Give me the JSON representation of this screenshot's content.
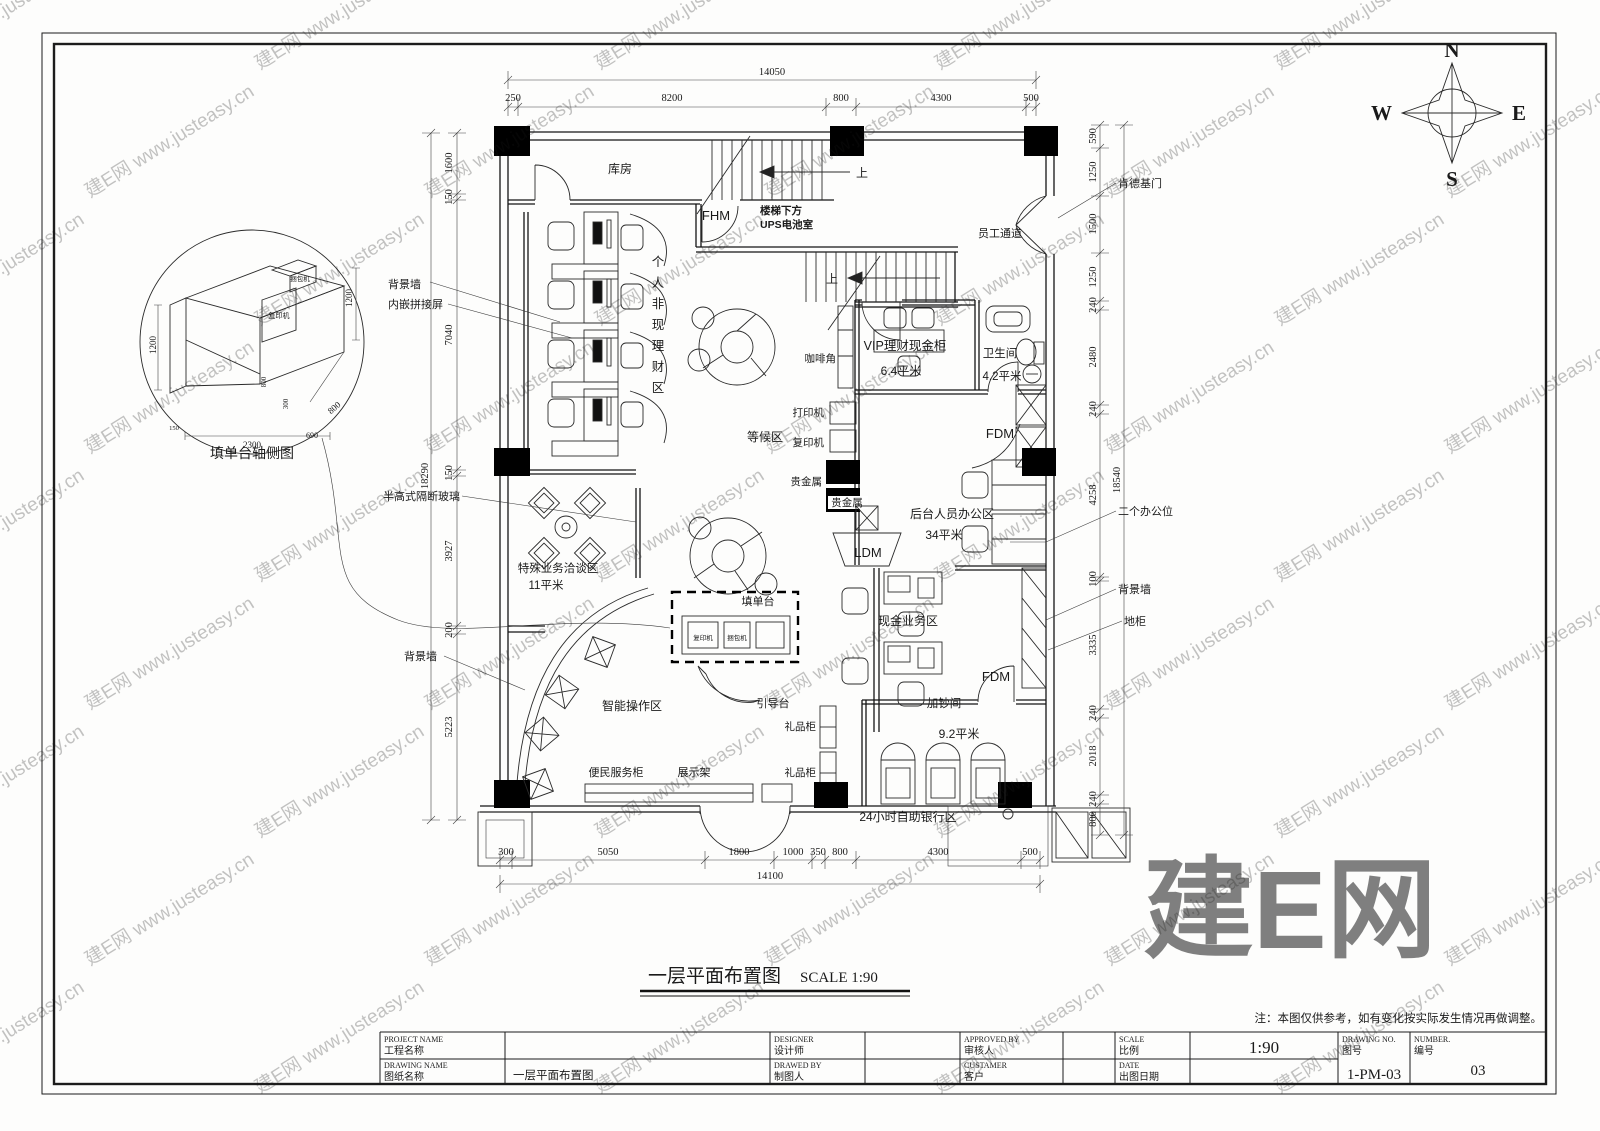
{
  "watermark": {
    "text": "建E网 www.justeasy.cn",
    "big": "建E网"
  },
  "drawing_title": {
    "text": "一层平面布置图",
    "scale": "SCALE 1:90"
  },
  "note": "注：本图仅供参考，如有变化按实际发生情况再做调整。",
  "compass": {
    "n": "N",
    "e": "E",
    "s": "S",
    "w": "W"
  },
  "detail": {
    "caption": "填单台轴侧图",
    "machine_top": "捆包机",
    "machine_front": "复印机",
    "dims": [
      "1200",
      "1200",
      "800",
      "300",
      "800",
      "690",
      "2300",
      "150"
    ]
  },
  "title_block": {
    "fields": [
      {
        "en": "PROJECT NAME",
        "zh": "工程名称",
        "value": ""
      },
      {
        "en": "DRAWING NAME",
        "zh": "图纸名称",
        "value": "一层平面布置图"
      },
      {
        "en": "DESIGNER",
        "zh": "设计师",
        "value": ""
      },
      {
        "en": "DRAWED BY",
        "zh": "制图人",
        "value": ""
      },
      {
        "en": "APPROVED BY",
        "zh": "审核人",
        "value": ""
      },
      {
        "en": "CUSTAMER",
        "zh": "客户",
        "value": ""
      },
      {
        "en": "SCALE",
        "zh": "比例",
        "value": "1:90"
      },
      {
        "en": "DATE",
        "zh": "出图日期",
        "value": ""
      },
      {
        "en": "DRAWING NO.",
        "zh": "图号",
        "value": "1-PM-03"
      },
      {
        "en": "NUMBER.",
        "zh": "编号",
        "value": "03"
      }
    ]
  },
  "dimensions": {
    "top": {
      "overall": "14050",
      "segments": [
        "250",
        "8200",
        "800",
        "4300",
        "500"
      ]
    },
    "bottom": {
      "overall": "14100",
      "segments": [
        "300",
        "5050",
        "1800",
        "1000",
        "350",
        "800",
        "4300",
        "500"
      ]
    },
    "left": {
      "overall": "18290",
      "segments": [
        "1600",
        "150",
        "7040",
        "150",
        "3927",
        "200",
        "5223"
      ]
    },
    "right": {
      "overall": "18540",
      "segments": [
        "590",
        "1250",
        "1500",
        "1250",
        "240",
        "2480",
        "240",
        "4258",
        "100",
        "3335",
        "240",
        "2018",
        "240",
        "800"
      ]
    }
  },
  "plan": {
    "labels": [
      {
        "i": "storeroom",
        "x": 620,
        "y": 173,
        "t": "库房"
      },
      {
        "i": "fhm-door",
        "x": 716,
        "y": 220,
        "t": "FHM",
        "s": 13
      },
      {
        "i": "ups-room-line1",
        "x": 760,
        "y": 214,
        "t": "楼梯下方",
        "s": 10.5,
        "a": "s",
        "b": 1
      },
      {
        "i": "ups-room-line2",
        "x": 760,
        "y": 228,
        "t": "UPS电池室",
        "s": 10.5,
        "a": "s",
        "b": 1
      },
      {
        "i": "stairs-up-1",
        "x": 862,
        "y": 177,
        "t": "上",
        "s": 12
      },
      {
        "i": "stairs-up-2",
        "x": 838,
        "y": 283,
        "t": "上",
        "s": 12,
        "a": "e"
      },
      {
        "i": "personal-finance-zone",
        "x": 658,
        "y": 266,
        "t": "个人非现理财区",
        "s": 12.5,
        "v": 1
      },
      {
        "i": "waiting-zone",
        "x": 765,
        "y": 441,
        "t": "等候区",
        "s": 12
      },
      {
        "i": "staff-corridor",
        "x": 1000,
        "y": 237,
        "t": "员工通道",
        "s": 11
      },
      {
        "i": "coffee-corner",
        "x": 836,
        "y": 362,
        "t": "咖啡角",
        "s": 10.5,
        "a": "e"
      },
      {
        "i": "vip-cash-room",
        "x": 905,
        "y": 350,
        "t": "VIP理财现金柜",
        "s": 12.5
      },
      {
        "i": "vip-cash-area",
        "x": 901,
        "y": 375,
        "t": "6.4平米",
        "s": 12
      },
      {
        "i": "toilet",
        "x": 1000,
        "y": 357,
        "t": "卫生间",
        "s": 11.5
      },
      {
        "i": "toilet-area",
        "x": 1002,
        "y": 380,
        "t": "4.2平米",
        "s": 11.5
      },
      {
        "i": "printer",
        "x": 824,
        "y": 416,
        "t": "打印机",
        "s": 10.5,
        "a": "e"
      },
      {
        "i": "copier",
        "x": 824,
        "y": 446,
        "t": "复印机",
        "s": 10.5,
        "a": "e"
      },
      {
        "i": "precious-metal-1",
        "x": 822,
        "y": 485,
        "t": "贵金属",
        "s": 10.5,
        "a": "e"
      },
      {
        "i": "precious-metal-2",
        "x": 847,
        "y": 506,
        "t": "贵金属",
        "s": 10.5
      },
      {
        "i": "fdm-upper",
        "x": 1000,
        "y": 438,
        "t": "FDM",
        "s": 13
      },
      {
        "i": "backoffice-zone",
        "x": 952,
        "y": 518,
        "t": "后台人员办公区",
        "s": 12
      },
      {
        "i": "backoffice-area",
        "x": 944,
        "y": 539,
        "t": "34平米",
        "s": 12
      },
      {
        "i": "ldm-machine",
        "x": 868,
        "y": 557,
        "t": "LDM",
        "s": 13
      },
      {
        "i": "cash-business-zone",
        "x": 908,
        "y": 625,
        "t": "现金业务区",
        "s": 12
      },
      {
        "i": "form-desk",
        "x": 758,
        "y": 605,
        "t": "填单台",
        "s": 11
      },
      {
        "i": "special-business-zone",
        "x": 558,
        "y": 572,
        "t": "特殊业务洽谈区",
        "s": 11.5
      },
      {
        "i": "special-business-area",
        "x": 546,
        "y": 589,
        "t": "11平米",
        "s": 11.5
      },
      {
        "i": "smart-zone",
        "x": 632,
        "y": 710,
        "t": "智能操作区",
        "s": 12
      },
      {
        "i": "guide-desk",
        "x": 773,
        "y": 707,
        "t": "引导台",
        "s": 11
      },
      {
        "i": "gift-cabinet-1",
        "x": 816,
        "y": 730,
        "t": "礼品柜",
        "s": 10.5,
        "a": "e"
      },
      {
        "i": "gift-cabinet-2",
        "x": 816,
        "y": 776,
        "t": "礼品柜",
        "s": 10.5,
        "a": "e"
      },
      {
        "i": "cash-add-room",
        "x": 944,
        "y": 707,
        "t": "加钞间",
        "s": 11.5
      },
      {
        "i": "cash-add-area",
        "x": 959,
        "y": 738,
        "t": "9.2平米",
        "s": 12
      },
      {
        "i": "fdm-lower",
        "x": 996,
        "y": 681,
        "t": "FDM",
        "s": 13
      },
      {
        "i": "atm-24h-zone",
        "x": 908,
        "y": 821,
        "t": "24小时自助银行区",
        "s": 12
      },
      {
        "i": "convenience-cabinet",
        "x": 616,
        "y": 776,
        "t": "便民服务柜",
        "s": 11
      },
      {
        "i": "display-rack",
        "x": 694,
        "y": 776,
        "t": "展示架",
        "s": 11
      },
      {
        "i": "bg-wall-left-1",
        "x": 388,
        "y": 288,
        "t": "背景墙",
        "s": 11,
        "a": "s"
      },
      {
        "i": "inlay-screen",
        "x": 388,
        "y": 308,
        "t": "内嵌拼接屏",
        "s": 11,
        "a": "s"
      },
      {
        "i": "half-glass-partition",
        "x": 383,
        "y": 500,
        "t": "半高式隔断玻璃",
        "s": 11,
        "a": "s"
      },
      {
        "i": "bg-wall-left-2",
        "x": 404,
        "y": 660,
        "t": "背景墙",
        "s": 11,
        "a": "s"
      },
      {
        "i": "kfc-door",
        "x": 1118,
        "y": 187,
        "t": "肯德基门",
        "s": 11,
        "a": "s"
      },
      {
        "i": "two-workstations",
        "x": 1118,
        "y": 515,
        "t": "二个办公位",
        "s": 11,
        "a": "s"
      },
      {
        "i": "bg-wall-right",
        "x": 1118,
        "y": 593,
        "t": "背景墙",
        "s": 11,
        "a": "s"
      },
      {
        "i": "floor-cabinet",
        "x": 1124,
        "y": 625,
        "t": "地柜",
        "s": 11,
        "a": "s"
      },
      {
        "i": "form-desk-copier",
        "x": 703,
        "y": 640,
        "t": "复印机",
        "s": 6.5
      },
      {
        "i": "form-desk-bundler",
        "x": 737,
        "y": 640,
        "t": "捆包机",
        "s": 6.5
      }
    ]
  }
}
